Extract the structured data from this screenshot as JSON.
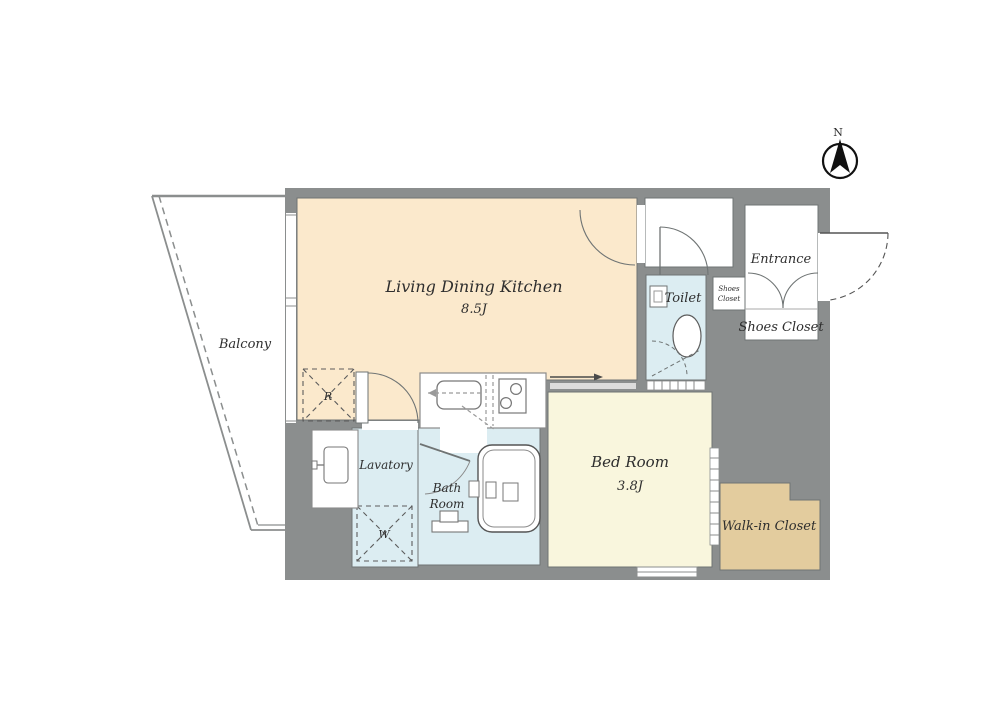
{
  "plan": {
    "compass_label": "N",
    "rooms": {
      "ldk": {
        "name": "Living Dining Kitchen",
        "size": "8.5J",
        "color": "#fbe9cc"
      },
      "bedroom": {
        "name": "Bed Room",
        "size": "3.8J",
        "color": "#f9f6dd"
      },
      "toilet": {
        "name": "Toilet",
        "color": "#dcedf2"
      },
      "bath": {
        "line1": "Bath",
        "line2": "Room",
        "color": "#dcedf2"
      },
      "lavatory": {
        "name": "Lavatory",
        "color": "#dcedf2"
      },
      "entrance": {
        "name": "Entrance"
      },
      "shoes_closet": {
        "name": "Shoes Closet"
      },
      "shoes_closet_small": {
        "line1": "Shoes",
        "line2": "Closet"
      },
      "walk_in_closet": {
        "name": "Walk-in Closet",
        "color": "#e3cc9e"
      },
      "balcony": {
        "name": "Balcony"
      }
    },
    "fixtures": {
      "refrigerator": "R",
      "washing_machine": "W"
    },
    "colors": {
      "wall": "#8b8e8e",
      "outline": "#6f7474",
      "background": "#ffffff"
    }
  }
}
